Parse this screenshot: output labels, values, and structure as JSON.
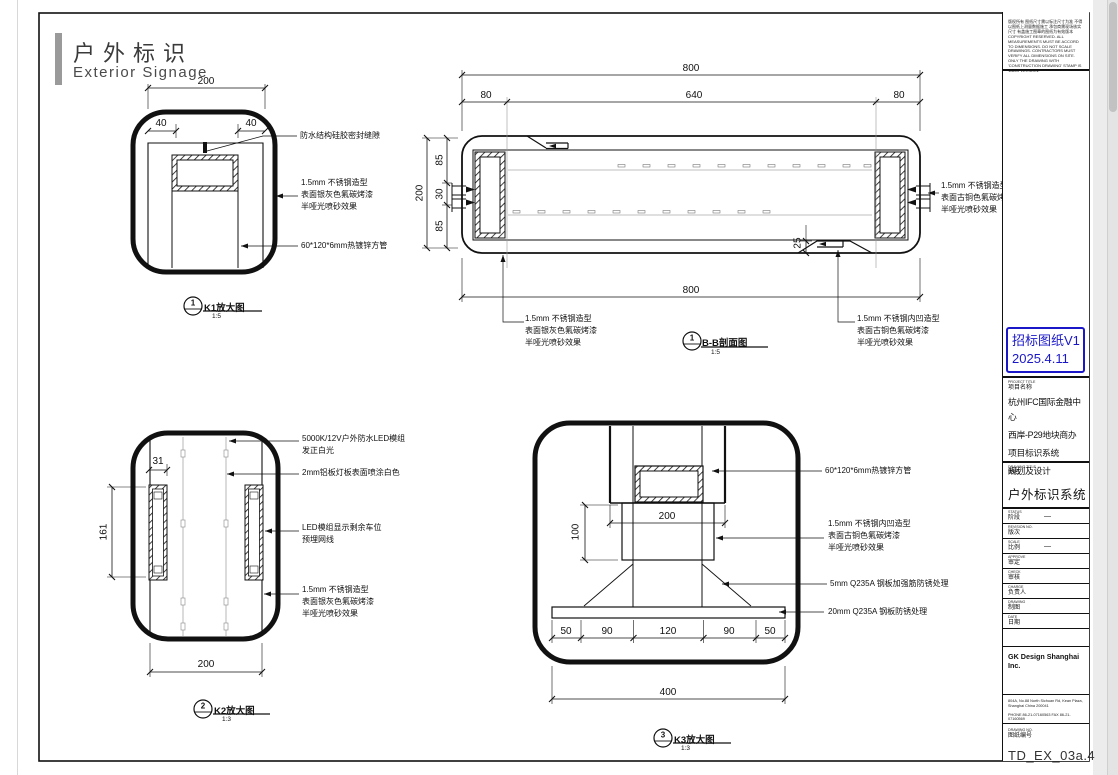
{
  "header": {
    "title_cn": "户外标识",
    "title_en": "Exterior Signage"
  },
  "line_color": "#111111",
  "k1": {
    "dim_200": "200",
    "dim_40l": "40",
    "dim_40r": "40",
    "ann_seal": "防水结构硅胶密封缝隙",
    "ann_steel": [
      "1.5mm 不锈钢造型",
      "表面银灰色氟碳烤漆",
      "半哑光喷砂效果"
    ],
    "ann_tube": "60*120*6mm热镀锌方管",
    "bubble_no": "1",
    "label": "K1放大图",
    "scale": "1:5"
  },
  "bb": {
    "dim_800_top": "800",
    "dim_80l": "80",
    "dim_640": "640",
    "dim_80r": "80",
    "dim_200": "200",
    "dim_85t": "85",
    "dim_30": "30",
    "dim_85b": "85",
    "dim_25": "25",
    "dim_800_bottom": "800",
    "ann_left": [
      "1.5mm 不锈钢造型",
      "表面银灰色氟碳烤漆",
      "半哑光喷砂效果"
    ],
    "ann_right_side": [
      "1.5mm 不锈钢造型",
      "表面古铜色氟碳烤漆",
      "半哑光喷砂效果"
    ],
    "ann_right_bottom": [
      "1.5mm 不锈钢内凹造型",
      "表面古铜色氟碳烤漆",
      "半哑光喷砂效果"
    ],
    "bubble_no": "1",
    "label": "B-B剖面图",
    "scale": "1:5"
  },
  "k2": {
    "dim_31": "31",
    "dim_161": "161",
    "dim_200": "200",
    "ann_led": [
      "5000K/12V户外防水LED模组",
      "发正白光"
    ],
    "ann_panel": "2mm铝板灯板表面喷涂白色",
    "ann_display": [
      "LED模组显示剩余车位",
      "预埋网线"
    ],
    "ann_steel": [
      "1.5mm 不锈钢造型",
      "表面银灰色氟碳烤漆",
      "半哑光喷砂效果"
    ],
    "bubble_no": "2",
    "label": "K2放大图",
    "scale": "1:3"
  },
  "k3": {
    "dim_200": "200",
    "dim_100": "100",
    "dims_bottom": [
      "50",
      "90",
      "120",
      "90",
      "50"
    ],
    "dim_400": "400",
    "ann_tube": "60*120*6mm热镀锌方管",
    "ann_steel": [
      "1.5mm 不锈钢内凹造型",
      "表面古铜色氟碳烤漆",
      "半哑光喷砂效果"
    ],
    "ann_rib": "5mm Q235A 钢板加强筋防锈处理",
    "ann_plate": "20mm Q235A 钢板防锈处理",
    "bubble_no": "3",
    "label": "K3放大图",
    "scale": "1:3"
  },
  "titleblock": {
    "disclaimer_cn": "版权所有 图纸尺寸需以标注尺寸为准 不得以图纸上测量数据施工 承包商需现场核实尺寸 有盖施工图章的图纸为有效版本",
    "disclaimer_en": "COPYRIGHT RESERVED. ALL MEASUREMENTS MUST BE ACCORD TO DIMENSIONS. DO NOT SCALE DRAWINGS. CONTRACTORS MUST VERIFY ALL DIMENSIONS ON SITE. ONLY THE DRAWING WITH 'CONSTRUCTION DRAWING' STAMP IS VALID VERSION.",
    "stamp_line1": "招标图纸V1",
    "stamp_line2": "2025.4.11",
    "stamp_color": "#1a17c9",
    "project_label_en": "PROJECT TITLE",
    "project_label_cn": "项目名称",
    "project_lines": [
      "杭州IFC国际金融中心",
      "西岸-P29地块商办",
      "项目标识系统",
      "规划及设计"
    ],
    "drawing_title_label_en": "DRAWING TITLE",
    "drawing_title_label_cn": "图名",
    "drawing_title": "户外标识系统",
    "rows": [
      {
        "en": "STATUS",
        "cn": "阶段",
        "value": "—"
      },
      {
        "en": "REVISION NO.",
        "cn": "版次",
        "value": ""
      },
      {
        "en": "SCALE",
        "cn": "比例",
        "value": "—"
      },
      {
        "en": "APPROVE",
        "cn": "审定",
        "value": ""
      },
      {
        "en": "CHECK",
        "cn": "审核",
        "value": ""
      },
      {
        "en": "CHARGE",
        "cn": "负责人",
        "value": ""
      },
      {
        "en": "DRAWING",
        "cn": "制图",
        "value": ""
      },
      {
        "en": "DATE",
        "cn": "日期",
        "value": ""
      }
    ],
    "company": "GK Design Shanghai Inc.",
    "address_lines": [
      "804A, No.88 North Sichuan Rd, Kean Plaza,",
      "Shanghai China 200041"
    ],
    "phone_line": "PHONE 86-21-07160563 FAX 86-21-07160569",
    "drawing_no_label_en": "DRAWING NO.",
    "drawing_no_label_cn": "图纸编号",
    "drawing_no": "TD_EX_03a.4"
  }
}
